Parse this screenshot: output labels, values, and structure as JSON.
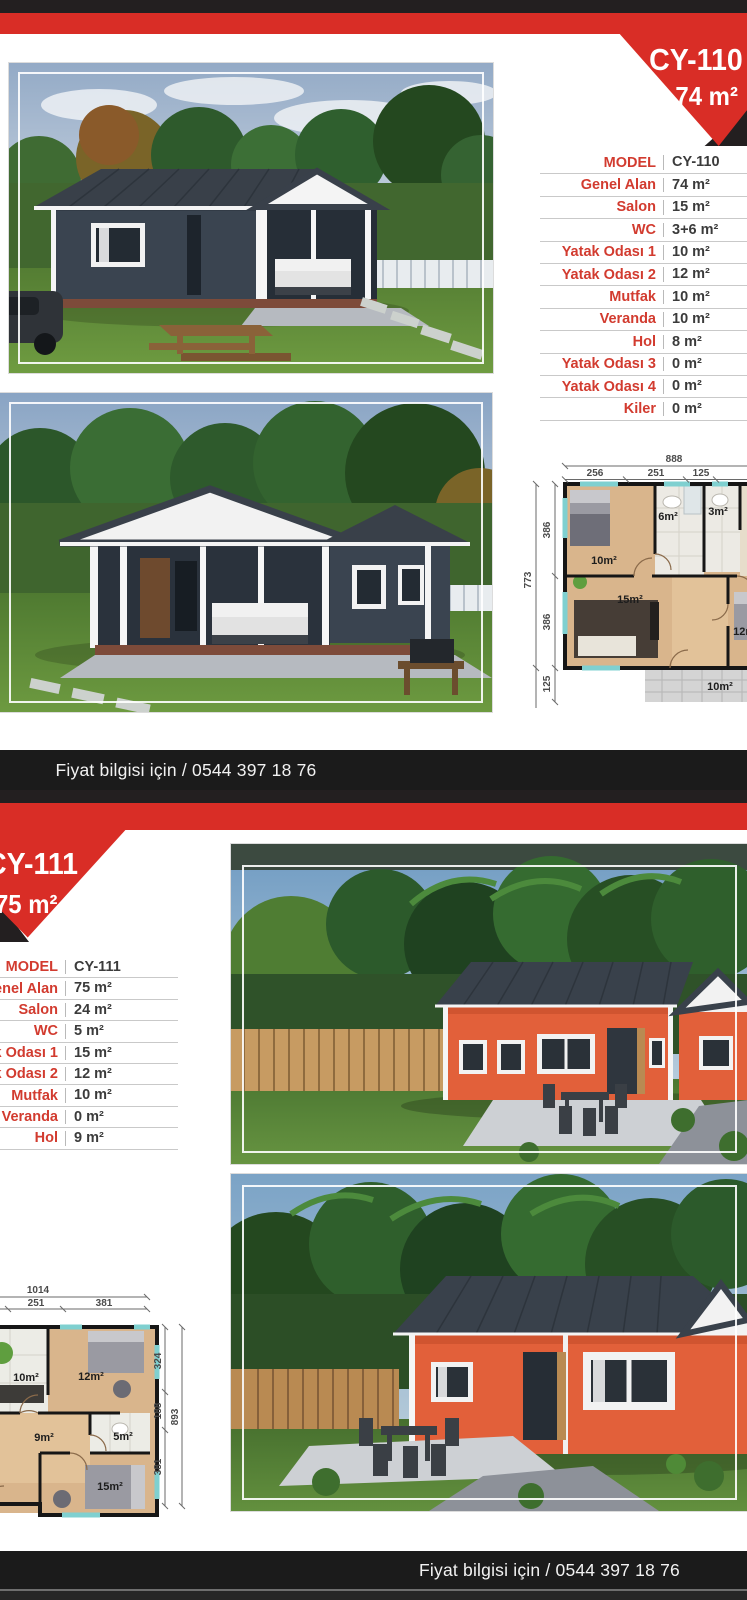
{
  "brand_colors": {
    "red": "#d92d26",
    "dark": "#231f20",
    "bar": "#1b1b1b",
    "label_red": "#d23b2f"
  },
  "contact": {
    "price_info": "Fiyat bilgisi için / 0544 397 18 76"
  },
  "models": [
    {
      "code": "CY-110",
      "area": "74 m²",
      "specs": [
        {
          "label": "MODEL",
          "value": "CY-110"
        },
        {
          "label": "Genel Alan",
          "value": "74 m²"
        },
        {
          "label": "Salon",
          "value": "15 m²"
        },
        {
          "label": "WC",
          "value": "3+6 m²"
        },
        {
          "label": "Yatak Odası 1",
          "value": "10 m²"
        },
        {
          "label": "Yatak Odası 2",
          "value": "12 m²"
        },
        {
          "label": "Mutfak",
          "value": "10 m²"
        },
        {
          "label": "Veranda",
          "value": "10 m²"
        },
        {
          "label": "Hol",
          "value": "8 m²"
        },
        {
          "label": "Yatak Odası 3",
          "value": "0 m²"
        },
        {
          "label": "Yatak Odası 4",
          "value": "0 m²"
        },
        {
          "label": "Kiler",
          "value": "0 m²"
        }
      ],
      "plan": {
        "total_width": "888",
        "top_segments": [
          "256",
          "251",
          "125"
        ],
        "total_height": "773",
        "left_segments": [
          "386",
          "386",
          "125"
        ],
        "rooms": {
          "bedroom1": "10m²",
          "bath": "6m²",
          "wc": "3m²",
          "salon": "15m²",
          "bedroom2": "12m²",
          "veranda": "10m²"
        }
      }
    },
    {
      "code": "CY-111",
      "area": "75 m²",
      "specs": [
        {
          "label": "MODEL",
          "value": "CY-111"
        },
        {
          "label": "Genel Alan",
          "value": "75 m²"
        },
        {
          "label": "Salon",
          "value": "24 m²"
        },
        {
          "label": "WC",
          "value": "5 m²"
        },
        {
          "label": "Yatak Odası 1",
          "value": "15 m²"
        },
        {
          "label": "Yatak Odası 2",
          "value": "12 m²"
        },
        {
          "label": "Mutfak",
          "value": "10 m²"
        },
        {
          "label": "Veranda",
          "value": "0 m²"
        },
        {
          "label": "Hol",
          "value": "9 m²"
        }
      ],
      "plan": {
        "total_width": "1014",
        "top_segments": [
          "251",
          "381"
        ],
        "total_height": "893",
        "right_segments": [
          "324",
          "188",
          "381"
        ],
        "rooms": {
          "kitchen": "10m²",
          "bedroom1": "12m²",
          "wc": "5m²",
          "hall": "9m²",
          "bedroom2": "15m²"
        }
      }
    }
  ]
}
